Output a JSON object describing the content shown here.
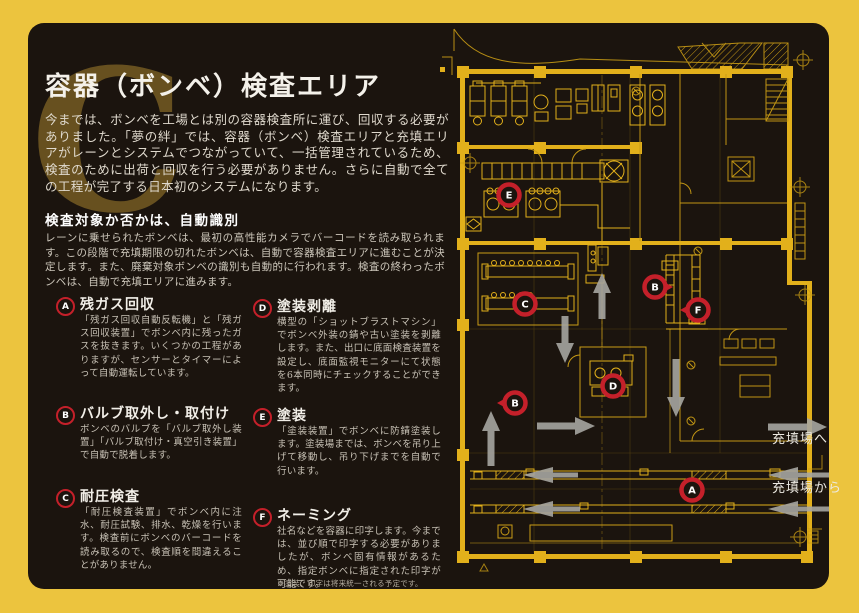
{
  "page": {
    "bg_color": "#ECC43E",
    "panel_color": "#1B140E",
    "accent_red": "#C4202A",
    "plan_yellow": "#E2B01B",
    "arrow_gray": "#A6A5A1"
  },
  "header": {
    "ornament_letter": "C",
    "title": "容器（ボンベ）検査エリア",
    "intro": "今までは、ボンベを工場とは別の容器検査所に運び、回収する必要がありました。「夢の絆」では、容器（ボンベ）検査エリアと充填エリアがレーンとシステムでつながっていて、一括管理されているため、検査のために出荷と回収を行う必要がありません。さらに自動で全ての工程が完了する日本初のシステムになります。"
  },
  "auto_detect": {
    "heading": "検査対象か否かは、自動識別",
    "body": "レーンに乗せられたボンベは、最初の高性能カメラでバーコードを読み取られます。この段階で充填期限の切れたボンベは、自動で容器検査エリアに進むことが決定します。また、廃棄対象ボンベの識別も自動的に行われます。検査の終わったボンベは、自動で充填エリアに進みます。"
  },
  "steps": [
    {
      "letter": "A",
      "title": "残ガス回収",
      "body": "「残ガス回収自動反転機」と「残ガス回収装置」でボンベ内に残ったガスを抜きます。いくつかの工程がありますが、センサーとタイマーによって自動運転しています。",
      "cx": 56,
      "cy": 297,
      "tx": 80,
      "ty": 294,
      "by": 314,
      "w": 162
    },
    {
      "letter": "B",
      "title": "バルブ取外し・取付け",
      "body": "ボンベのバルブを「バルブ取外し装置」「バルブ取付け・真空引き装置」で自動で脱着します。",
      "cx": 56,
      "cy": 406,
      "tx": 80,
      "ty": 403,
      "by": 423,
      "w": 162
    },
    {
      "letter": "C",
      "title": "耐圧検査",
      "body": "「耐圧検査装置」でボンベ内に注水、耐圧試験、排水、乾燥を行います。検査前にボンベのバーコードを読み取るので、検査順を間違えることがありません。",
      "cx": 56,
      "cy": 489,
      "tx": 80,
      "ty": 486,
      "by": 506,
      "w": 162
    },
    {
      "letter": "D",
      "title": "塗装剥離",
      "body": "横型の「ショットブラストマシン」でボンベ外装の錆や古い塗装を剥離します。また、出口に底面検査装置を設定し、底面監視モニターにて状態を6本同時にチェックすることができます。",
      "cx": 253,
      "cy": 299,
      "tx": 277,
      "ty": 296,
      "by": 316,
      "w": 164
    },
    {
      "letter": "E",
      "title": "塗装",
      "body": "「塗装装置」でボンベに防錆塗装します。塗装場までは、ボンベを吊り上げて移動し、吊り下げまでを自動で行います。",
      "cx": 253,
      "cy": 408,
      "tx": 277,
      "ty": 405,
      "by": 425,
      "w": 164
    },
    {
      "letter": "F",
      "title": "ネーミング",
      "body": "社名などを容器に印字します。今までは、並び順で印字する必要がありましたが、ボンベ固有情報があるため、指定ボンベに指定された印字が可能です。",
      "note": "※塗装、印字は将来統一される予定です。",
      "cx": 253,
      "cy": 508,
      "tx": 277,
      "ty": 505,
      "by": 525,
      "w": 164
    }
  ],
  "plan": {
    "labels": [
      {
        "name": "to-filling-area",
        "text": "充填場へ",
        "x": 332,
        "y": 420
      },
      {
        "name": "from-filling-area",
        "text": "充填場から",
        "x": 332,
        "y": 469
      }
    ],
    "markers": [
      {
        "letter": "E",
        "x": 69,
        "y": 172,
        "pointer": "none"
      },
      {
        "letter": "C",
        "x": 85,
        "y": 281,
        "pointer": "none"
      },
      {
        "letter": "B",
        "x": 215,
        "y": 264,
        "pointer": "right"
      },
      {
        "letter": "F",
        "x": 258,
        "y": 287,
        "pointer": "left"
      },
      {
        "letter": "D",
        "x": 173,
        "y": 363,
        "pointer": "none"
      },
      {
        "letter": "B",
        "x": 75,
        "y": 380,
        "pointer": "left"
      },
      {
        "letter": "A",
        "x": 252,
        "y": 467,
        "pointer": "none"
      }
    ],
    "arrows": [
      {
        "dir": "up",
        "x": 162,
        "tip": 250,
        "tail": 296,
        "size": "small"
      },
      {
        "dir": "down",
        "x": 125,
        "tip": 340,
        "tail": 293,
        "size": "small"
      },
      {
        "dir": "down",
        "x": 236,
        "tip": 394,
        "tail": 336,
        "size": "small"
      },
      {
        "dir": "up",
        "x": 51,
        "tip": 388,
        "tail": 443,
        "size": "small"
      },
      {
        "dir": "right",
        "y": 403,
        "tip": 155,
        "tail": 97,
        "size": "small"
      },
      {
        "dir": "right",
        "y": 404,
        "tip": 387,
        "tail": 328,
        "size": "small"
      },
      {
        "dir": "left",
        "y": 452,
        "tip": 83,
        "tail": 138,
        "size": "big"
      },
      {
        "dir": "left",
        "y": 452,
        "tip": 328,
        "tail": 389,
        "size": "big"
      },
      {
        "dir": "left",
        "y": 486,
        "tip": 83,
        "tail": 140,
        "size": "big"
      },
      {
        "dir": "left",
        "y": 486,
        "tip": 328,
        "tail": 389,
        "size": "big"
      }
    ]
  }
}
